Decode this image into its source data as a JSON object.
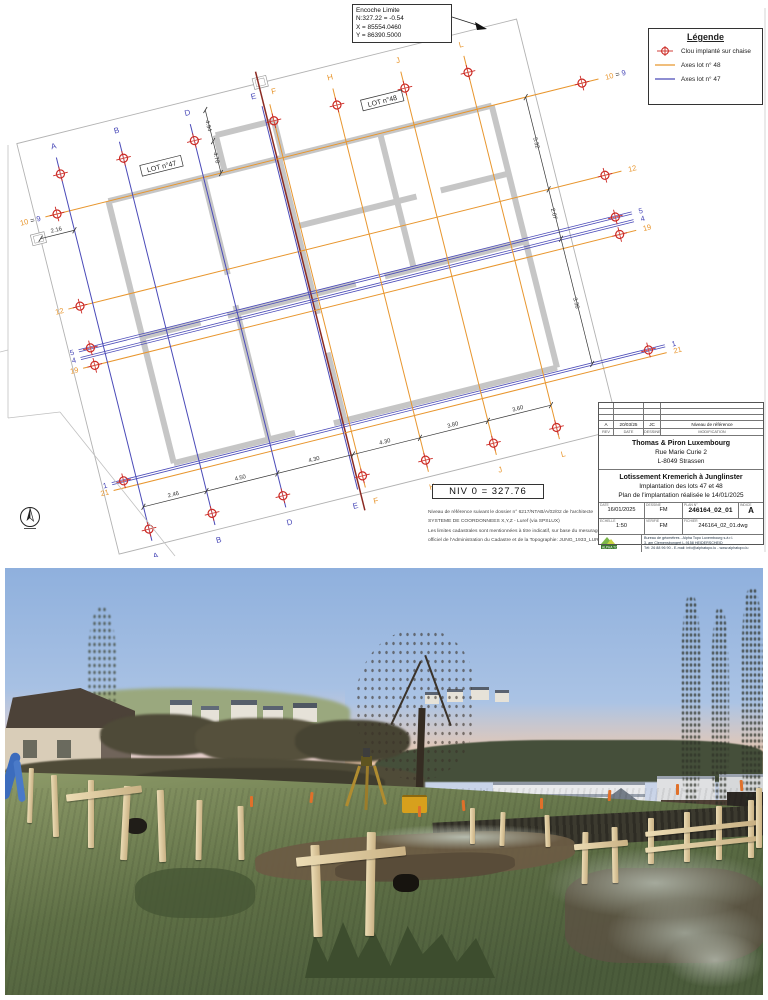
{
  "page": {
    "bg": "#ffffff"
  },
  "plan": {
    "colors": {
      "lot47": "#4a4ab8",
      "lot48": "#e8962e",
      "marker": "#cc2a24",
      "wall": "#c6c6c6",
      "red_axis": "#8b2a22",
      "dim": "#333333",
      "parcel": "#b2b2b2",
      "dk": "#333333"
    },
    "legend": {
      "title": "Légende",
      "items": [
        {
          "symbol": "clou-marker-icon",
          "label": "Clou implanté sur chaise"
        },
        {
          "symbol": "lot48-line-icon",
          "label": "Axes lot n° 48"
        },
        {
          "symbol": "lot47-line-icon",
          "label": "Axes lot n° 47"
        }
      ]
    },
    "callout": {
      "line1": "Encoche Limite",
      "line2": "N:327.22 = -0.54",
      "line3": "X = 85554.0460",
      "line4": "Y = 86390.5000"
    },
    "niv_label": "NIV 0 = 327.76",
    "notes": {
      "line1": "Niveau de référence suivant le dossier n° 6217/NTAB/A/02/02 de l'architecte",
      "line2": "SYSTEME DE COORDONNEES X,Y,Z - Luref (via SPSLUX)",
      "line3": "Les limites cadastrales sont mentionnées à titre indicatif, sur base du mesurage officiel de l'Administration du Cadastre et de la Topographie: JUNG_1933_LUR"
    },
    "grid": {
      "col_top": 95,
      "col_bottom": 490,
      "row_left": 115,
      "row_right": 685
    },
    "columns": [
      {
        "label": "A",
        "lot": "47",
        "x": 140
      },
      {
        "label": "B",
        "lot": "47",
        "x": 205
      },
      {
        "label": "D",
        "lot": "47",
        "x": 278
      },
      {
        "label": "E",
        "lot": "47",
        "x": 352,
        "ldx": -6,
        "nomark": true
      },
      {
        "label": "F",
        "lot": "48",
        "x": 360,
        "ldx": 7
      },
      {
        "label": "H",
        "lot": "48",
        "x": 425
      },
      {
        "label": "J",
        "lot": "48",
        "x": 495
      },
      {
        "label": "L",
        "lot": "48",
        "x": 560
      }
    ],
    "rows": [
      {
        "y": 150,
        "lot": "48",
        "parts": [
          [
            "10",
            "48"
          ],
          [
            " = ",
            "dk"
          ],
          [
            "9",
            "47"
          ]
        ]
      },
      {
        "y": 245,
        "lot": "48",
        "parts": [
          [
            "12",
            "48"
          ]
        ]
      },
      {
        "y": 288,
        "lot": "47",
        "double": true,
        "parts": [
          [
            "5",
            "47"
          ]
        ]
      },
      {
        "y": 296,
        "lot": "47",
        "double": true,
        "nomark": true,
        "parts": [
          [
            "4",
            "47"
          ]
        ]
      },
      {
        "y": 306,
        "lot": "48",
        "parts": [
          [
            "19",
            "48"
          ]
        ]
      },
      {
        "y": 425,
        "lot": "47",
        "double": true,
        "parts": [
          [
            "1",
            "47"
          ]
        ]
      },
      {
        "y": 432,
        "lot": "48",
        "nomark": true,
        "parts": [
          [
            "21",
            "48"
          ]
        ]
      }
    ],
    "lot_boxes": [
      {
        "label": "LOT n°47",
        "x": 240,
        "y": 130
      },
      {
        "label": "LOT n°48",
        "x": 470,
        "y": 120
      }
    ],
    "parcel": [
      [
        105,
        72
      ],
      [
        620,
        72
      ],
      [
        620,
        495
      ],
      [
        105,
        495
      ]
    ],
    "notches": [
      [
        96,
        164
      ],
      [
        349,
        66
      ]
    ],
    "walls": [
      [
        180,
        150,
        575,
        150
      ],
      [
        575,
        150,
        575,
        420
      ],
      [
        575,
        420,
        345,
        420
      ],
      [
        305,
        420,
        180,
        420
      ],
      [
        180,
        420,
        180,
        150
      ],
      [
        278,
        150,
        278,
        250
      ],
      [
        278,
        282,
        278,
        420
      ],
      [
        356,
        150,
        356,
        310
      ],
      [
        356,
        350,
        356,
        420
      ],
      [
        460,
        150,
        460,
        290
      ],
      [
        180,
        290,
        240,
        290
      ],
      [
        268,
        290,
        400,
        290
      ],
      [
        430,
        290,
        575,
        290
      ],
      [
        356,
        220,
        480,
        220
      ],
      [
        505,
        220,
        575,
        220
      ],
      [
        300,
        112,
        300,
        150
      ],
      [
        300,
        112,
        360,
        112
      ],
      [
        360,
        112,
        360,
        150
      ]
    ],
    "red_axis": {
      "x": 356,
      "y1": 60,
      "y2": 512
    },
    "dims": {
      "bottom": {
        "y": 455,
        "x1": 140,
        "x2": 560,
        "ticks": [
          140,
          205,
          278,
          356,
          425,
          495,
          560
        ],
        "labels": [
          {
            "at": 172,
            "t": "2.46"
          },
          {
            "at": 241,
            "t": "4.50"
          },
          {
            "at": 317,
            "t": "4.30"
          },
          {
            "at": 390,
            "t": "4.30"
          },
          {
            "at": 460,
            "t": "3.80"
          },
          {
            "at": 527,
            "t": "3.60"
          }
        ]
      },
      "right": {
        "x": 610,
        "y1": 150,
        "y2": 425,
        "ticks": [
          150,
          245,
          296,
          425
        ],
        "labels": [
          {
            "at": 197,
            "t": "5.32"
          },
          {
            "at": 270,
            "t": "2.07"
          },
          {
            "at": 362,
            "t": "3.36"
          }
        ]
      },
      "topleft": {
        "x": 296,
        "y1": 85,
        "y2": 150,
        "ticks": [
          85,
          117,
          150
        ],
        "labels": [
          {
            "at": 101,
            "t": "4.94"
          },
          {
            "at": 134,
            "t": "4.78"
          }
        ]
      },
      "left": {
        "y": 170,
        "x1": 105,
        "x2": 140,
        "label": "2.16"
      }
    }
  },
  "titleblock": {
    "revision": {
      "rev": "A",
      "date": "20/03/25",
      "by": "JC",
      "desc": "Niveau de référence"
    },
    "headers": {
      "rev": "REV",
      "date": "DATE",
      "by": "DESSINE",
      "desc": "MODIFICATION"
    },
    "client": {
      "line1": "Thomas & Piron Luxembourg",
      "line2": "Rue Marie Curie 2",
      "line3": "L-8049 Strassen"
    },
    "project": {
      "line1": "Lotissement Kremerich à Junglinster",
      "line2": "Implantation des lots 47 et 48",
      "line3": "Plan de l'implantation réalisée le 14/01/2025"
    },
    "meta": {
      "date_label": "DATE",
      "date": "16/01/2025",
      "scale_label": "ECHELLE",
      "scale": "1:50",
      "drawn_label": "DESSINE",
      "drawn": "FM",
      "checked_label": "VERIFIE",
      "checked": "FM",
      "plan_label": "PLAN N°",
      "plan_no": "246164_02_01",
      "file_label": "FICHIER",
      "file": "246164_02_01.dwg",
      "index_label": "INDICE",
      "index": "A"
    },
    "firm": {
      "logo_text": "ALPHA TOPO",
      "line1": "Bureau de géomètres - Alpha Topo Luxembourg s.à r.l.",
      "line2": "3, am Clemensbongert  L-9158 HEIDERSCHEID",
      "line3": "Tél: 26 88 96 90 - E-mail: info@alphatopo.lu - www.alphatopo.lu"
    }
  }
}
